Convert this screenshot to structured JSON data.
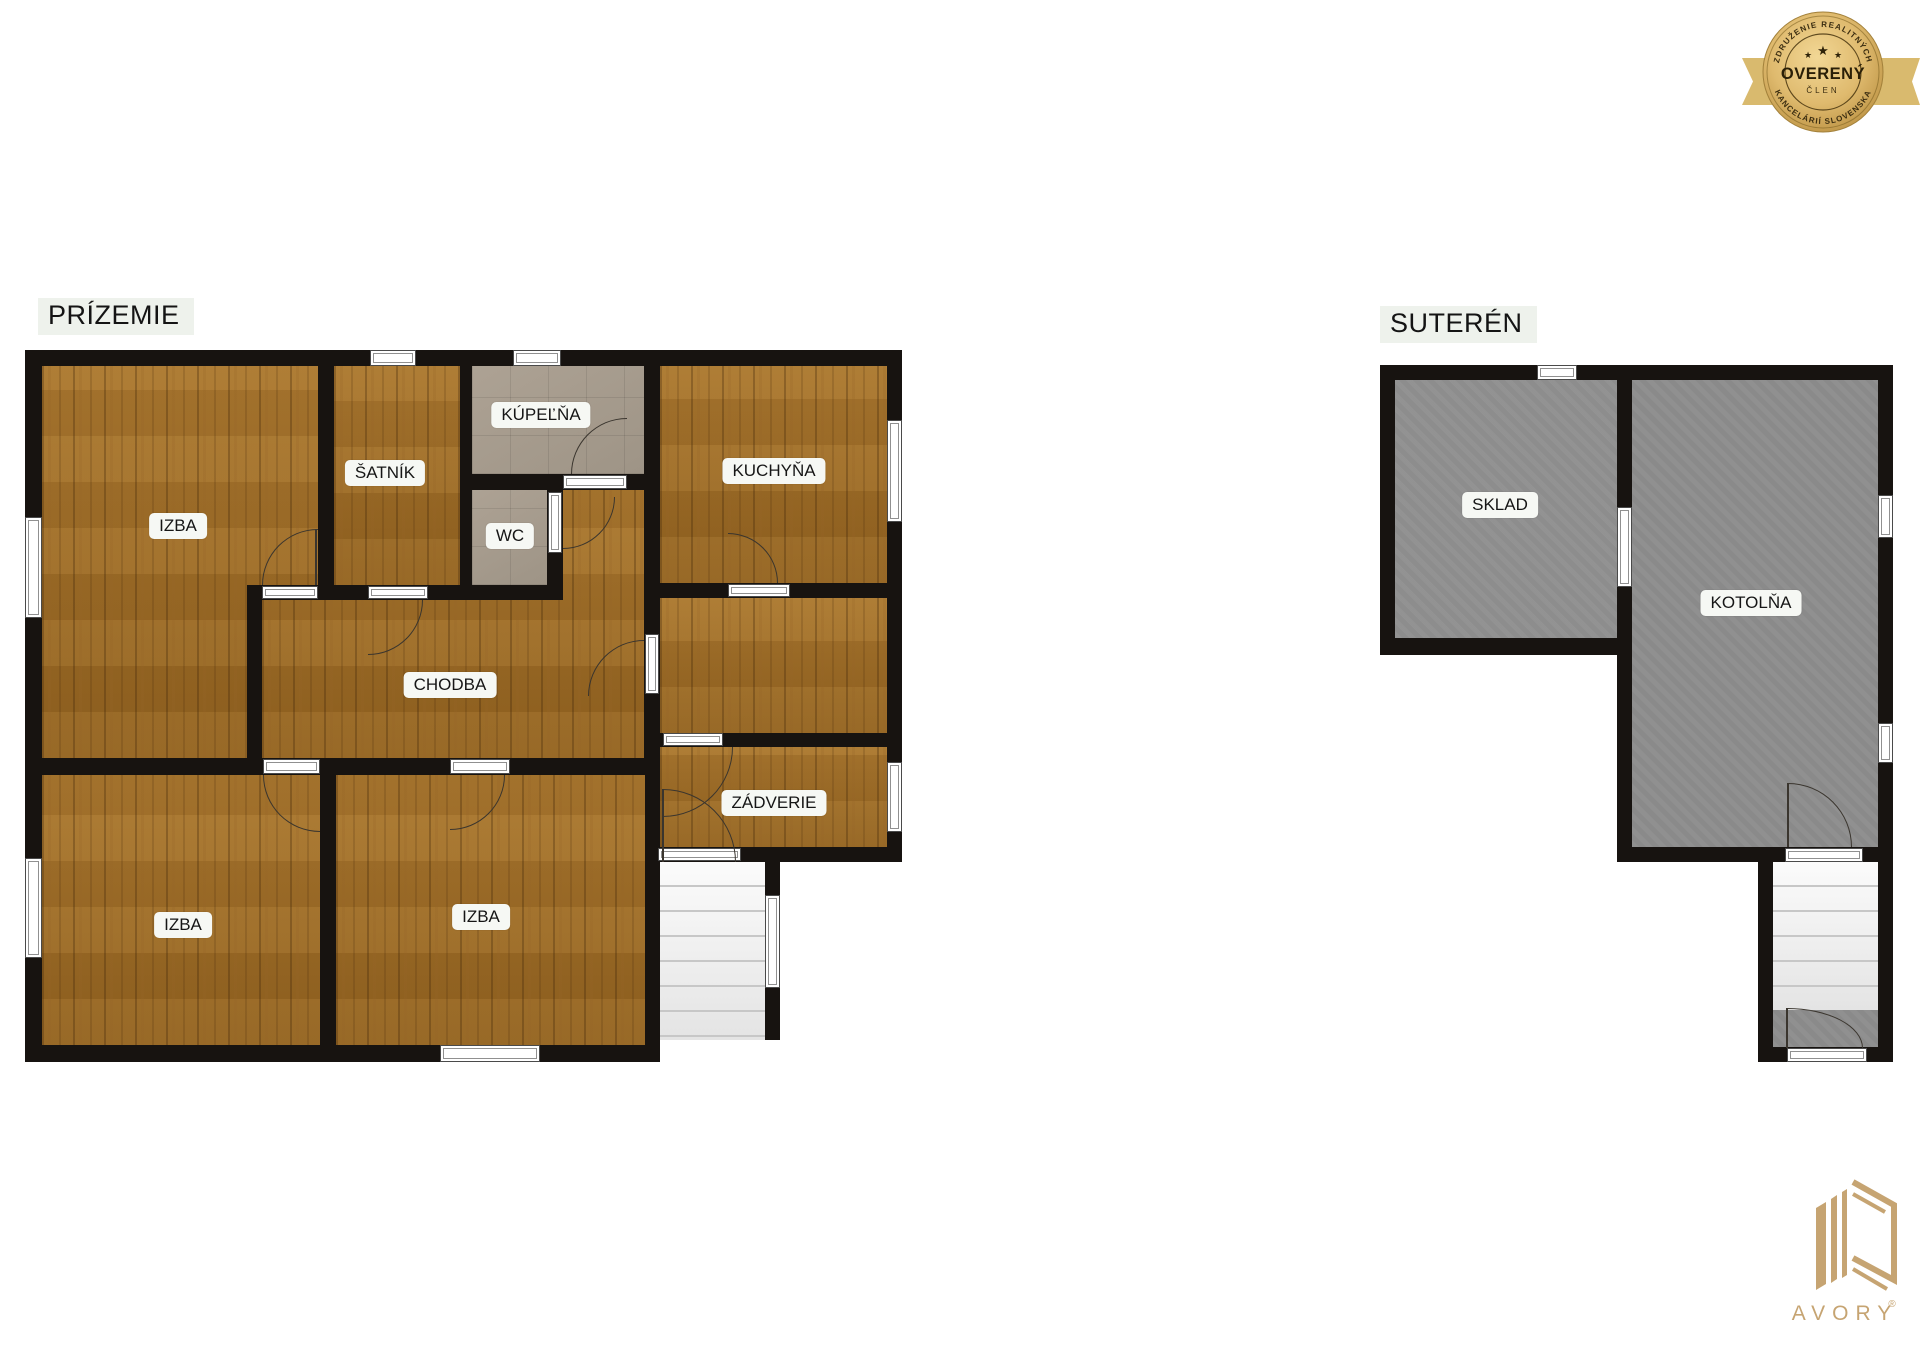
{
  "badge": {
    "arc_top": "ZDRUŽENIE REALITNÝCH",
    "arc_bottom": "KANCELÁRIÍ SLOVENSKA",
    "title": "OVERENÝ",
    "subtitle": "ČLEN",
    "star": "★"
  },
  "prizemie": {
    "title": "PRÍZEMIE",
    "rooms": {
      "izba_tl": "IZBA",
      "satnik": "ŠATNÍK",
      "kupelna": "KÚPEĽŇA",
      "wc": "WC",
      "kuchyna": "KUCHYŇA",
      "chodba": "CHODBA",
      "zadverie": "ZÁDVERIE",
      "izba_bl": "IZBA",
      "izba_bm": "IZBA"
    }
  },
  "suteren": {
    "title": "SUTERÉN",
    "rooms": {
      "sklad": "SKLAD",
      "kotolna": "KOTOLŇA"
    }
  },
  "logo": {
    "name": "AVORY",
    "registered": "®"
  },
  "colors": {
    "wall": "#171310",
    "wood_floor": "#9d6d2d",
    "tile_floor": "#a69c8e",
    "basement_floor": "#8d8d8d",
    "stairs": "#efefef",
    "label_background": "#f6f8f4",
    "badge_gold": "#dfba6e",
    "ribbon_gold": "#d9ba6e",
    "logo_gold": "#c6a472"
  }
}
